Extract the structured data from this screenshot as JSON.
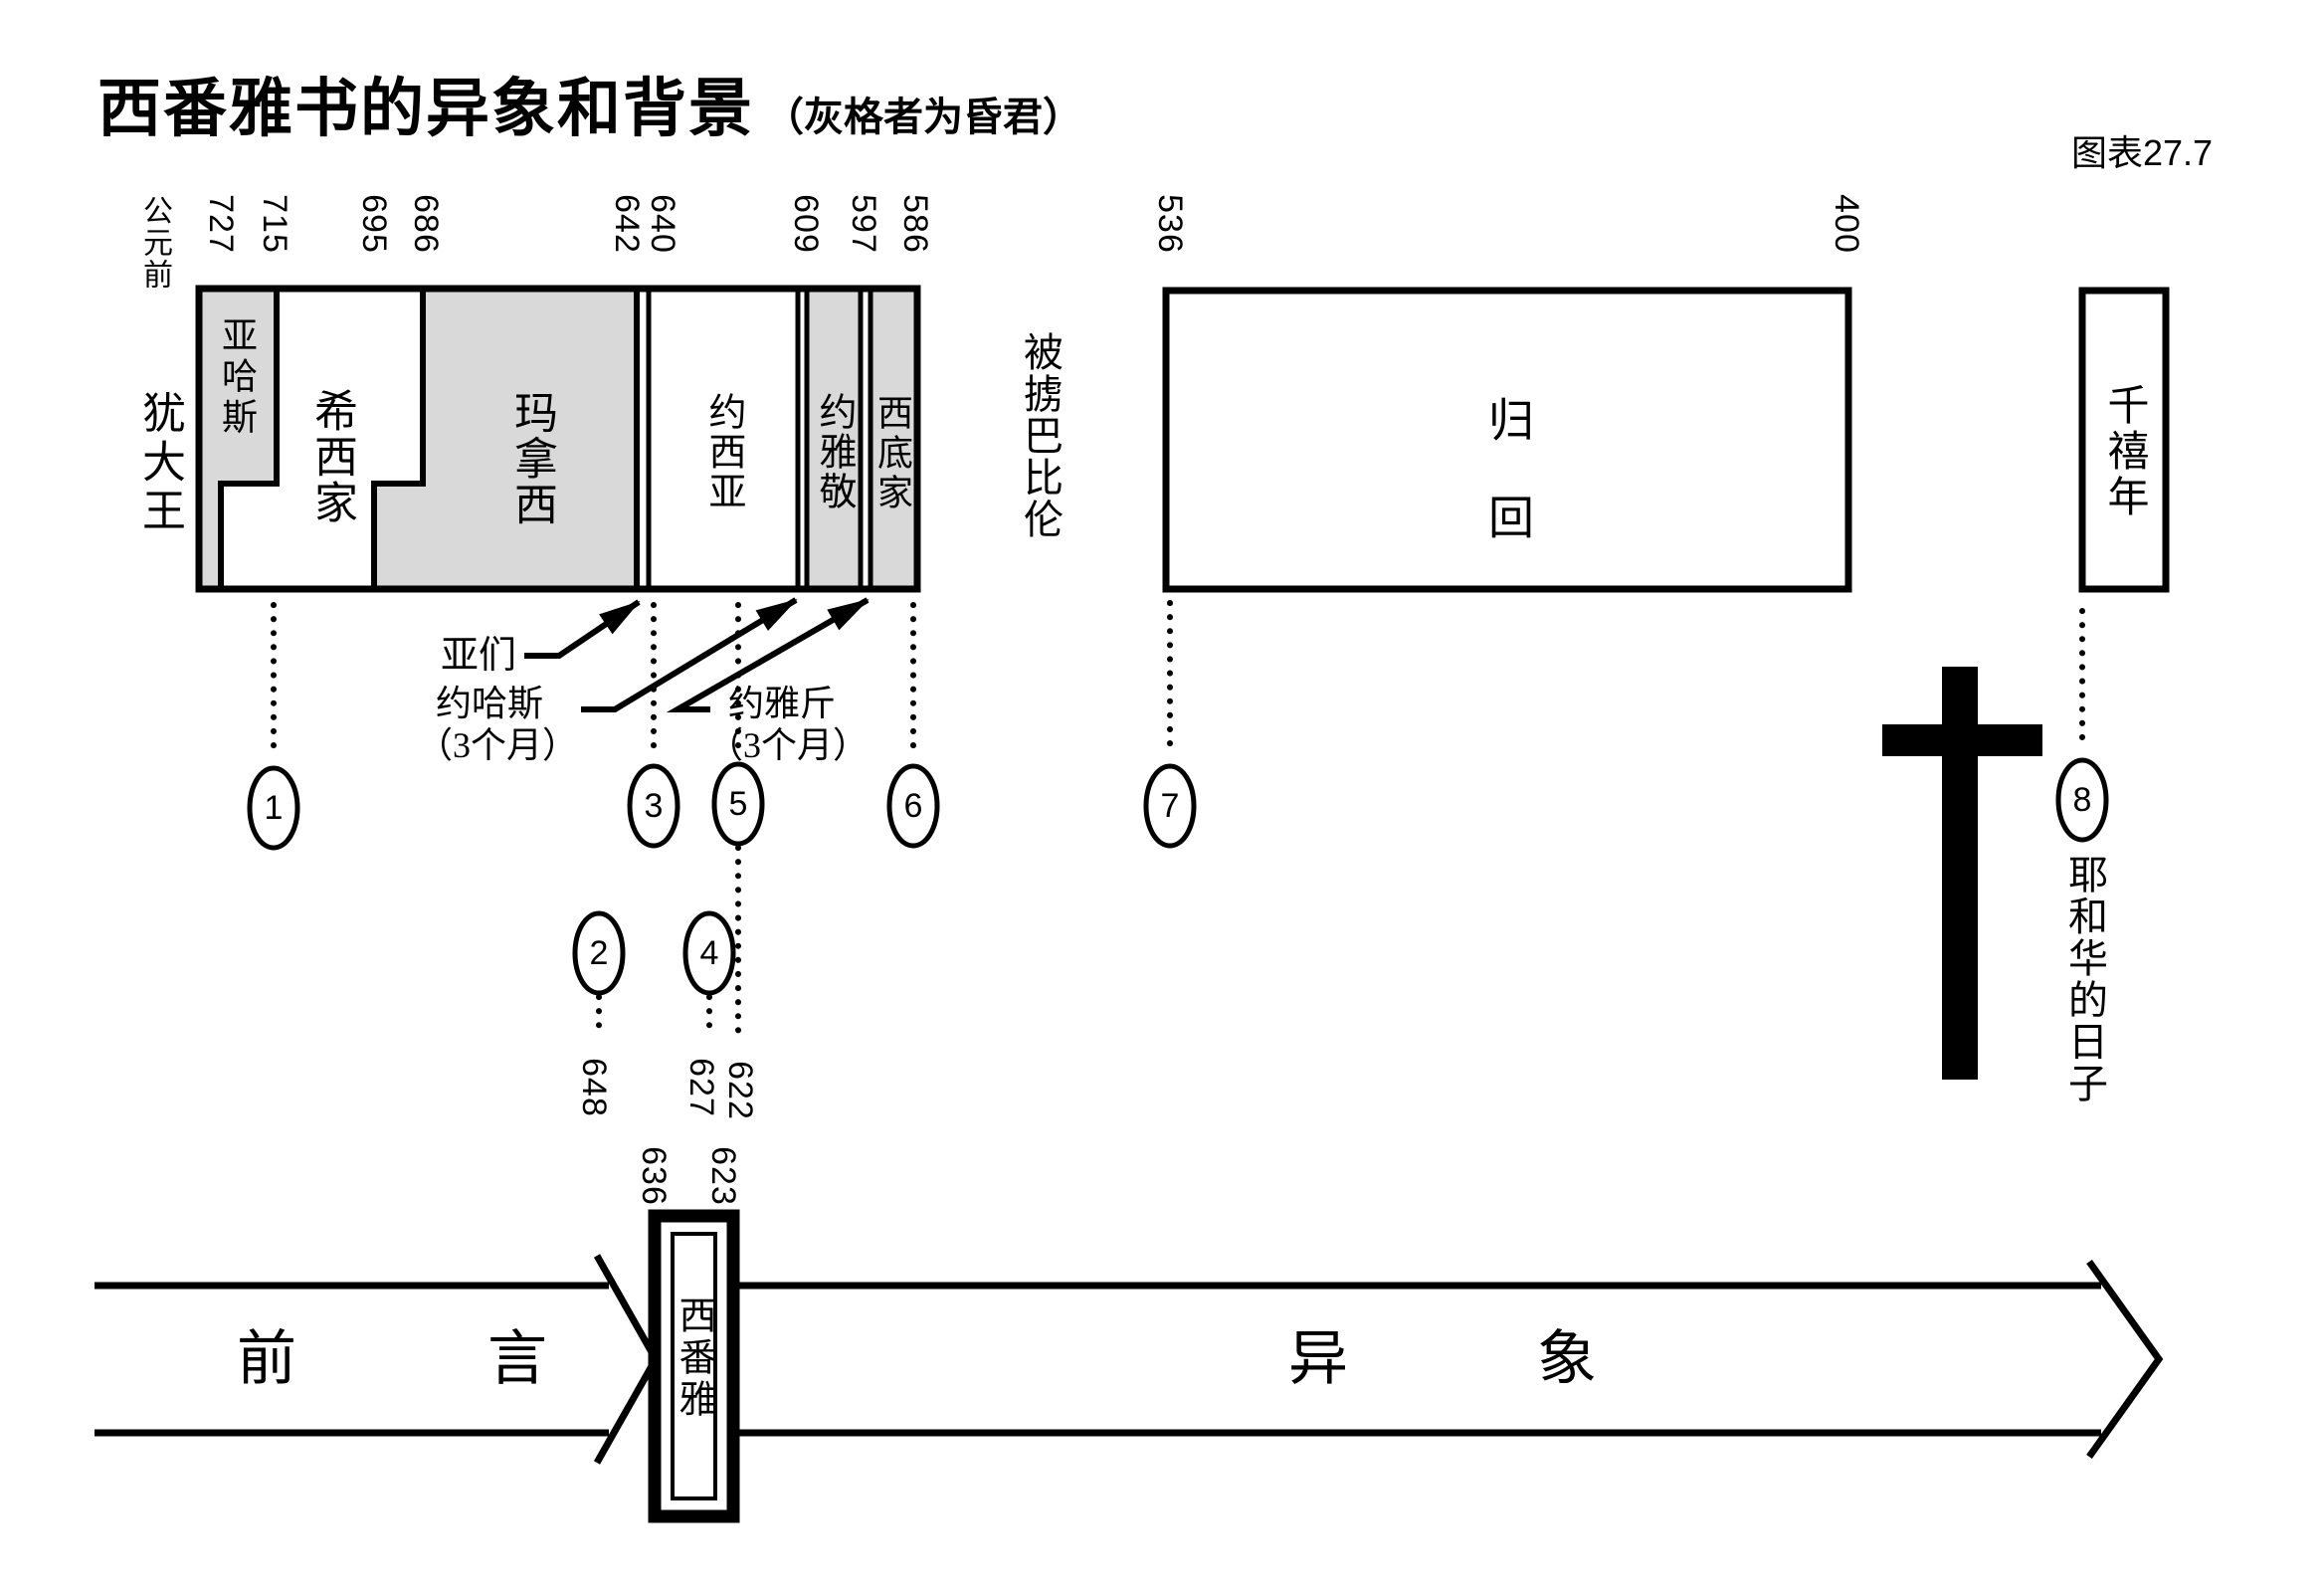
{
  "title": {
    "main": "西番雅书的异象和背景",
    "note": "（灰格者为昏君）",
    "figure_label": "图表27.7"
  },
  "timeline": {
    "era": "公元前",
    "years": [
      "727",
      "715",
      "695",
      "686",
      "642",
      "640",
      "609",
      "597",
      "586",
      "536",
      "400"
    ],
    "kings_axis_label": "犹大王",
    "kings": {
      "ahaz": "亚哈斯",
      "hezekiah": "希西家",
      "manasseh": "玛拿西",
      "josiah": "约西亚",
      "jehoiakim": "约雅敬",
      "zedekiah": "西底家"
    },
    "short_reigns": {
      "amon": "亚们",
      "jehoahaz": "约哈斯",
      "jehoahaz_duration": "（3个月）",
      "jehoiachin": "约雅斤",
      "jehoiachin_duration": "（3个月）"
    },
    "exile": "被掳巴比伦",
    "return_chars": "归回",
    "millennium": "千禧年",
    "day_of_the_lord": "耶和华的日子"
  },
  "markers": {
    "nums": [
      "1",
      "2",
      "3",
      "4",
      "5",
      "6",
      "7",
      "8"
    ],
    "years": {
      "m2": "648",
      "m4": "627",
      "m5": "622",
      "book_start": "636",
      "book_end": "623"
    }
  },
  "bottom": {
    "intro": "前言",
    "book": "西番雅",
    "visions": "异象"
  },
  "colors": {
    "evil_king_fill": "#d9d9d9",
    "ink": "#000000",
    "background": "#ffffff"
  }
}
